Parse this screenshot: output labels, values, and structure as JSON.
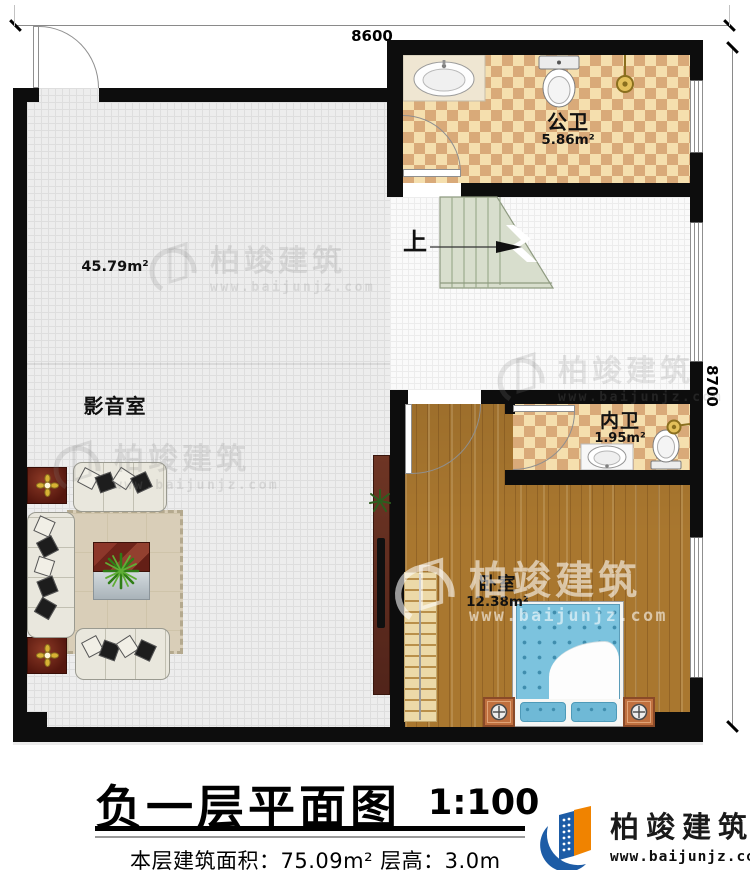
{
  "plan": {
    "dimension_top": "8600",
    "dimension_right": "8700",
    "stairs_label": "上",
    "rooms": {
      "public_bath": {
        "name": "公卫",
        "area": "5.86m²"
      },
      "media_room": {
        "name": "影音室",
        "area": "45.79m²"
      },
      "inner_bath": {
        "name": "内卫",
        "area": "1.95m²"
      },
      "bedroom": {
        "name": "卧室",
        "area": "12.38m²"
      }
    }
  },
  "title_block": {
    "title": "负一层平面图",
    "scale": "1:100",
    "stats": "本层建筑面积：75.09m²  层高：3.0m"
  },
  "branding": {
    "company": "柏竣建筑",
    "website": "www.baijunjz.com"
  },
  "watermark": {
    "company": "柏竣建筑",
    "website": "www.baijunjz.com"
  },
  "colors": {
    "wall": "#0d0d0d",
    "tile_light": "#f5dfae",
    "tile_dark": "#d9aa79",
    "wood_floor": "#a9772f",
    "stair": "#d8decd",
    "bed_blue": "#7cc3de",
    "nightstand_copper": "#c0703f",
    "logo_blue": "#1d5ca6",
    "logo_orange": "#f08300"
  }
}
